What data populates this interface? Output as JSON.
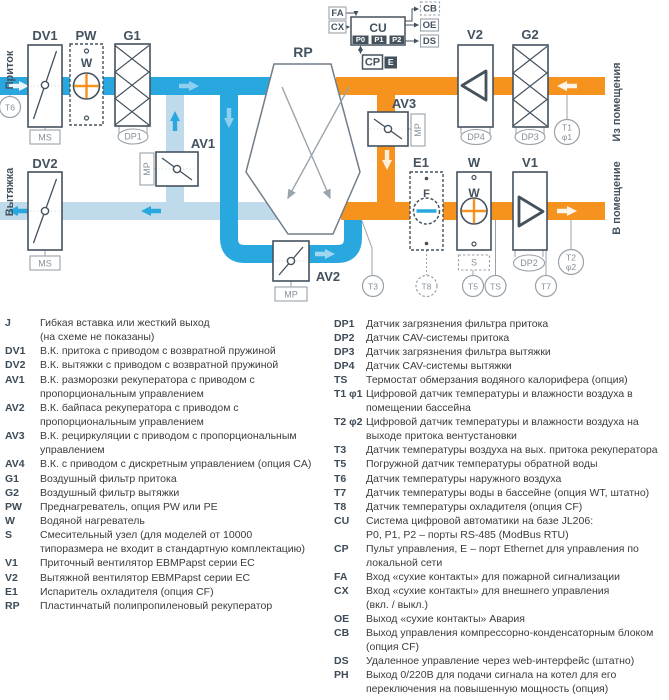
{
  "diagram": {
    "colors": {
      "supply_blue": "#29A8E0",
      "exhaust_pale": "#BFDAEA",
      "extract_orange": "#F6921E",
      "outline_ink": "#44525E",
      "line_gray": "#98A1A8"
    },
    "labels": {
      "pritok": "Приток",
      "vytyazhka": "Вытяжка",
      "iz_pom": "Из помещения",
      "v_pom": "В помещение",
      "dv1": "DV1",
      "dv2": "DV2",
      "pw": "PW",
      "g1": "G1",
      "g2": "G2",
      "rp": "RP",
      "v1": "V1",
      "v2": "V2",
      "av1": "AV1",
      "av2": "AV2",
      "av3": "AV3",
      "e1": "E1",
      "w": "W",
      "f": "F",
      "pw_w": "W",
      "w_w": "W",
      "cu": "CU",
      "cp": "CP",
      "fa": "FA",
      "cx": "CX",
      "cb": "CB",
      "oe": "OE",
      "ds": "DS",
      "e_port": "E",
      "p0": "P0",
      "p1": "P1",
      "p2": "P2",
      "ms1": "MS",
      "ms2": "MS",
      "mp1": "MP",
      "mp2": "MP",
      "mp3": "MP",
      "s": "S"
    },
    "sensors": {
      "t6": "T6",
      "t3": "T3",
      "t5": "T5",
      "t7": "T7",
      "t8": "T8",
      "ts": "TS",
      "t1": "T1",
      "phi1": "φ1",
      "t2": "T2",
      "phi2": "φ2",
      "dp1": "DP1",
      "dp2": "DP2",
      "dp3": "DP3",
      "dp4": "DP4"
    }
  },
  "legend": {
    "left": [
      {
        "abbr": "J",
        "lines": [
          "Гибкая вставка или жесткий выход",
          "(на схеме не показаны)"
        ]
      },
      {
        "abbr": "DV1",
        "lines": [
          "В.К. притока с приводом с возвратной пружиной"
        ]
      },
      {
        "abbr": "DV2",
        "lines": [
          "В.К. вытяжки с приводом с возвратной пружиной"
        ]
      },
      {
        "abbr": "AV1",
        "lines": [
          "В.К. разморозки рекуператора с приводом с",
          "пропорциональным управлением"
        ]
      },
      {
        "abbr": "AV2",
        "lines": [
          "В.К. байпаса рекуператора с приводом с",
          "пропорциональным управлением"
        ]
      },
      {
        "abbr": "AV3",
        "lines": [
          "В.К. рециркуляции с приводом с пропорциональным",
          "управлением"
        ]
      },
      {
        "abbr": "AV4",
        "lines": [
          "В.К. с приводом с дискретным управлением (опция CA)"
        ]
      },
      {
        "abbr": "G1",
        "lines": [
          "Воздушный фильтр притока"
        ]
      },
      {
        "abbr": "G2",
        "lines": [
          "Воздушный фильтр вытяжки"
        ]
      },
      {
        "abbr": "PW",
        "lines": [
          "Преднагреватель, опция PW или PE"
        ]
      },
      {
        "abbr": "W",
        "lines": [
          "Водяной нагреватель"
        ]
      },
      {
        "abbr": "S",
        "lines": [
          "Смесительный узел (для моделей от 10000",
          "типоразмера не входит в стандартную комплектацию)"
        ]
      },
      {
        "abbr": "V1",
        "lines": [
          "Приточный вентилятор EBMPapst серии EC"
        ]
      },
      {
        "abbr": "V2",
        "lines": [
          "Вытяжной вентилятор EBMPapst серии EC"
        ]
      },
      {
        "abbr": "E1",
        "lines": [
          "Испаритель охладителя (опция CF)"
        ]
      },
      {
        "abbr": "RP",
        "lines": [
          "Пластинчатый полипропиленовый рекуператор"
        ]
      }
    ],
    "right": [
      {
        "abbr": "DP1",
        "lines": [
          "Датчик загрязнения фильтра притока"
        ]
      },
      {
        "abbr": "DP2",
        "lines": [
          "Датчик CAV-системы притока"
        ]
      },
      {
        "abbr": "DP3",
        "lines": [
          "Датчик загрязнения фильтра вытяжки"
        ]
      },
      {
        "abbr": "DP4",
        "lines": [
          "Датчик CAV-системы вытяжки"
        ]
      },
      {
        "abbr": "TS",
        "lines": [
          "Термостат обмерзания водяного калорифера (опция)"
        ]
      },
      {
        "abbr": "T1 φ1",
        "lines": [
          "Цифровой датчик температуры и влажности воздуха в",
          "помещении бассейна"
        ]
      },
      {
        "abbr": "T2 φ2",
        "lines": [
          "Цифровой датчик температуры и влажности воздуха на",
          "выходе притока вентустановки"
        ]
      },
      {
        "abbr": "T3",
        "lines": [
          "Датчик температуры воздуха на вых. притока рекуператора"
        ]
      },
      {
        "abbr": "T5",
        "lines": [
          "Погружной датчик температуры обратной воды"
        ]
      },
      {
        "abbr": "T6",
        "lines": [
          "Датчик температуры наружного воздуха"
        ]
      },
      {
        "abbr": "T7",
        "lines": [
          "Датчик температуры воды в бассейне (опция WT, штатно)"
        ]
      },
      {
        "abbr": "T8",
        "lines": [
          "Датчик температуры охладителя (опция CF)"
        ]
      },
      {
        "abbr": "CU",
        "lines": [
          "Система цифровой автоматики на базе JL206:",
          "P0, P1, P2 – порты RS-485 (ModBus RTU)"
        ]
      },
      {
        "abbr": "CP",
        "lines": [
          "Пульт управления, E – порт Ethernet для управления по",
          "локальной сети"
        ]
      },
      {
        "abbr": "FA",
        "lines": [
          "Вход «сухие контакты» для пожарной сигнализации"
        ]
      },
      {
        "abbr": "CX",
        "lines": [
          "Вход  «сухие контакты» для внешнего управления",
          "(вкл. / выкл.)"
        ]
      },
      {
        "abbr": "OE",
        "lines": [
          "Выход «сухие контакты» Авария"
        ]
      },
      {
        "abbr": "CB",
        "lines": [
          "Выход управления компрессорно-конденсаторным блоком",
          "(опция CF)"
        ]
      },
      {
        "abbr": "DS",
        "lines": [
          "Удаленное управление через web-интерфейс (штатно)"
        ]
      },
      {
        "abbr": "PH",
        "lines": [
          "Выход 0/220В для подачи сигнала на котел для его",
          "переключения на повышенную мощность (опция)"
        ]
      }
    ]
  }
}
